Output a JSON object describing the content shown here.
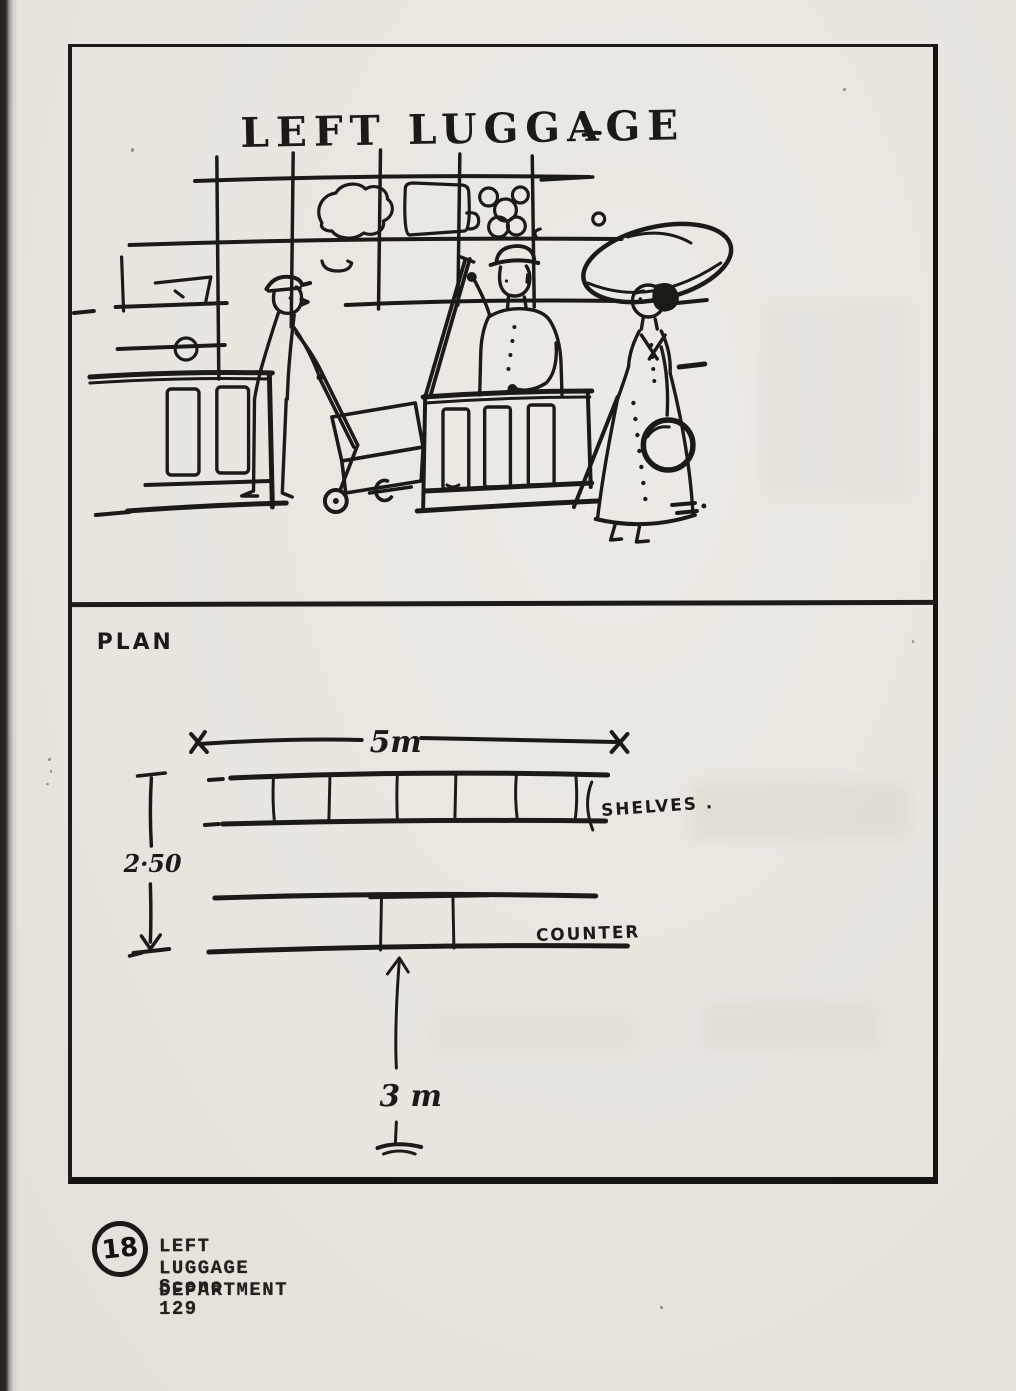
{
  "page": {
    "paper_color": "#e8e5df",
    "ink_color": "#1c1a16"
  },
  "sketch": {
    "sign": "LEFT LUGGAGE"
  },
  "plan": {
    "label": "PLAN",
    "width_dim": "5m",
    "depth_dim": "2·50",
    "aisle_dim": "3 m",
    "shelves_label": "SHELVES .",
    "counter_label": "COUNTER"
  },
  "caption": {
    "number": "18",
    "title": "LEFT LUGGAGE DEPARTMENT",
    "scene": "Scene 129"
  }
}
